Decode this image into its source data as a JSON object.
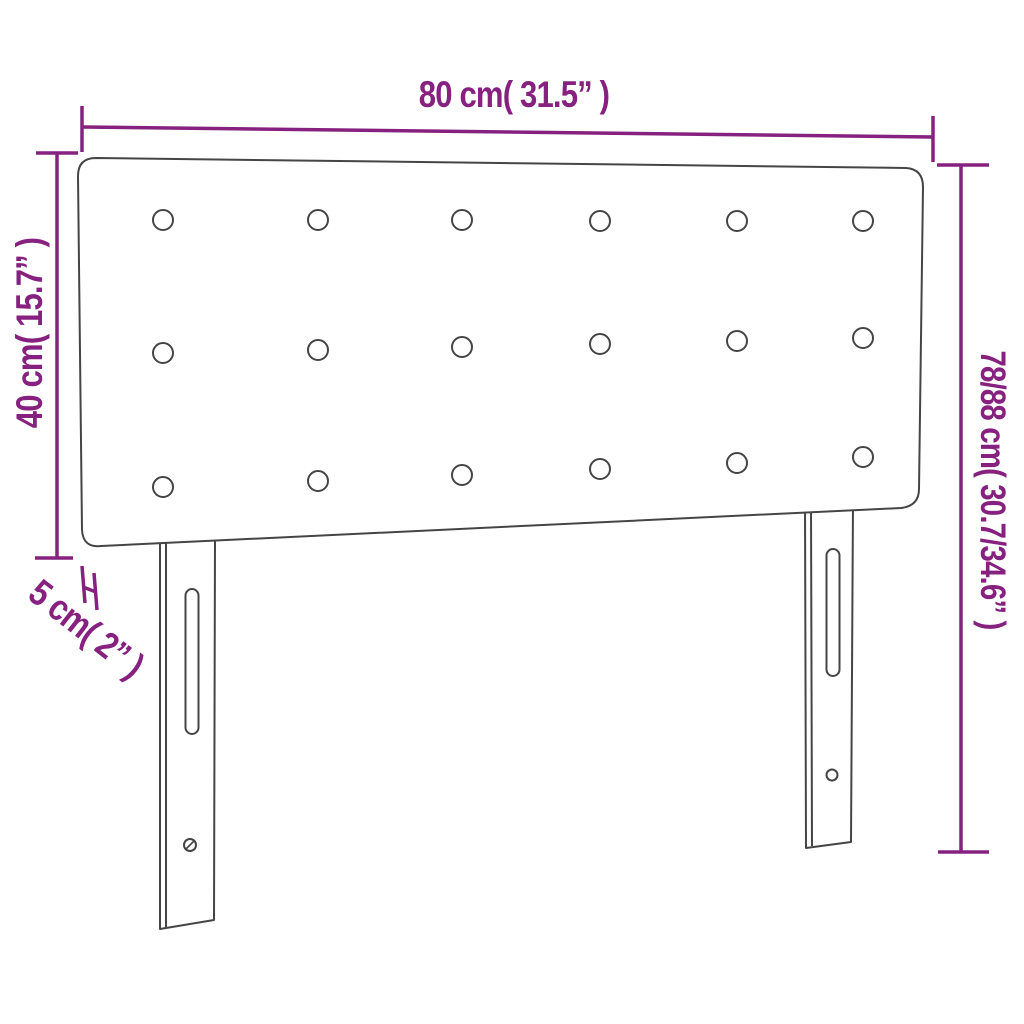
{
  "diagram": {
    "type": "product-dimension-diagram",
    "product": "upholstered headboard with legs",
    "dimensions": {
      "width": {
        "label": "80 cm( 31.5” )",
        "value_cm": "80",
        "value_in": "31.5"
      },
      "panel_height": {
        "label": "40 cm( 15.7” )",
        "value_cm": "40",
        "value_in": "15.7"
      },
      "total_height": {
        "label": "78/88 cm( 30.7/34.6” )",
        "value_cm": "78/88",
        "value_in": "30.7/34.6"
      },
      "thickness": {
        "label": "5 cm( 2” )",
        "value_cm": "5",
        "value_in": "2"
      }
    },
    "buttons": {
      "rows": 3,
      "columns": 6,
      "total": 18
    },
    "legs": {
      "count": 2,
      "features": [
        "adjustment-slot",
        "screw-hole"
      ]
    },
    "colors": {
      "dimension": "#862180",
      "outline": "#454545",
      "background": "#ffffff"
    }
  }
}
